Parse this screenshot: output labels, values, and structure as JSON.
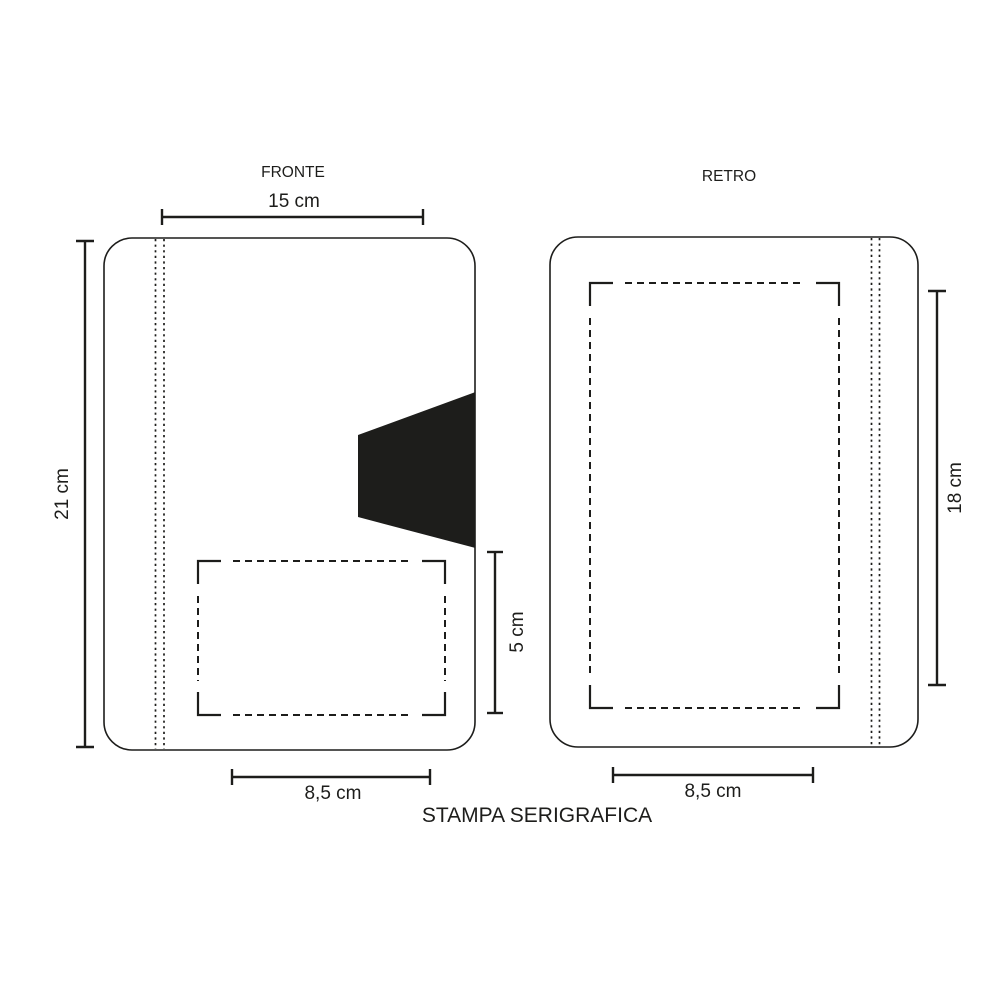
{
  "caption": "STAMPA SERIGRAFICA",
  "front": {
    "label": "FRONTE",
    "cover_width_label": "15 cm",
    "cover_height_label": "21 cm",
    "print_area_width_label": "8,5 cm",
    "print_area_height_label": "5 cm"
  },
  "back": {
    "label": "RETRO",
    "print_area_width_label": "8,5 cm",
    "print_area_height_label": "18 cm"
  },
  "colors": {
    "ink": "#1d1d1b",
    "background": "#ffffff"
  }
}
